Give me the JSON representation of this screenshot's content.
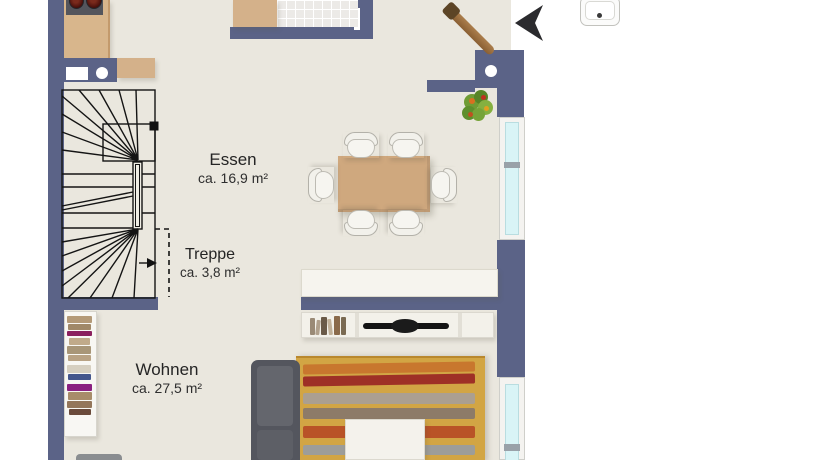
{
  "plan": {
    "type": "floor-plan",
    "rooms": [
      {
        "id": "essen",
        "label": "Essen",
        "area": "ca. 16,9 m²"
      },
      {
        "id": "treppe",
        "label": "Treppe",
        "area": "ca. 3,8 m²"
      },
      {
        "id": "wohnen",
        "label": "Wohnen",
        "area": "ca. 27,5 m²"
      }
    ],
    "icons": [
      "north-arrow-icon",
      "staircase-direction-arrow",
      "plant-icon",
      "guitar-decoration"
    ],
    "furniture": [
      "kitchen-counter",
      "stove",
      "counter-peninsula",
      "wc-sink",
      "sideboard-top",
      "dining-table",
      "dining-chairs-x6",
      "sideboard-dining",
      "tv-lowboard",
      "tv",
      "rug",
      "coffee-table",
      "sofa",
      "bookshelf"
    ],
    "colors": {
      "wall": "#5b6387",
      "floor": "#eae7de",
      "outside": "#ffffff",
      "window_glass": "#d9f4f6",
      "wood": "#d4b18a",
      "table": "#cfa87e",
      "rug": "#d2a544",
      "rug_stripes": [
        "#c8772e",
        "#9e3026",
        "#ab9f90",
        "#8d7b68",
        "#b95327",
        "#9d9d99"
      ],
      "sofa": "#54565e",
      "stair_line": "#141414"
    }
  }
}
